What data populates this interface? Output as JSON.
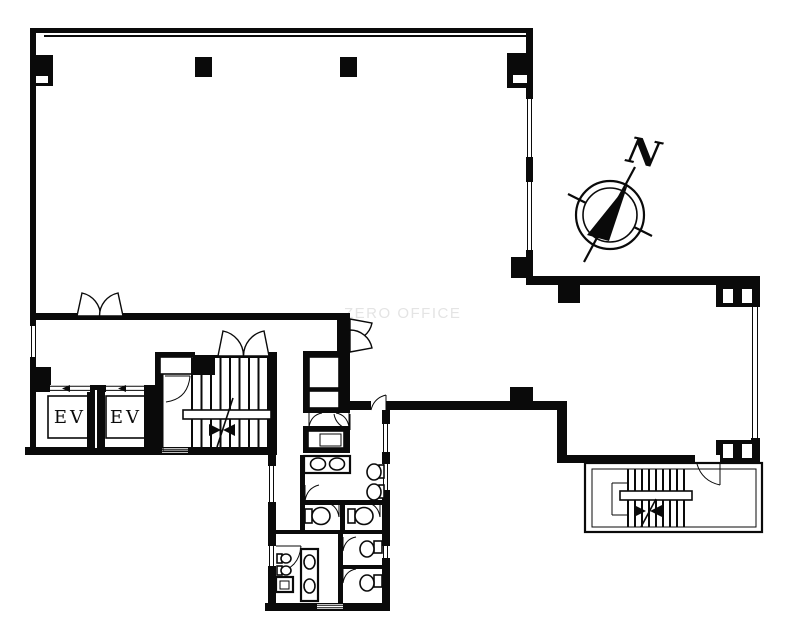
{
  "plan": {
    "watermark": "ZERO OFFICE",
    "compass": {
      "label": "N"
    },
    "elevators": {
      "ev1": "EV",
      "ev2": "EV"
    },
    "colors": {
      "ink": "#0a0a0a",
      "background": "#ffffff",
      "watermark": "#e4e4e4"
    }
  }
}
